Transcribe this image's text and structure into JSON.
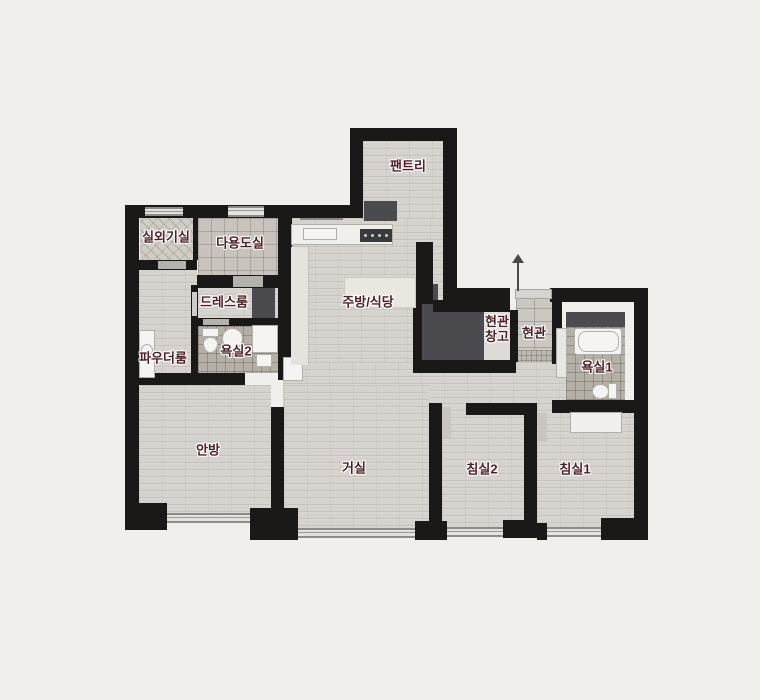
{
  "plan": {
    "type": "apartment-floor-plan",
    "colors": {
      "background": "#f0efeb",
      "wall": "#1b1917",
      "label": "#4d2127",
      "wood_floor": "#d6d3ce",
      "closet_dark": "#4b4a4e",
      "bath_tile": "#b4afa7"
    },
    "icons": {
      "entry_arrow": "arrow-up"
    },
    "rooms": {
      "pantry": {
        "label": "팬트리"
      },
      "outdoor_unit": {
        "label": "실외기실"
      },
      "utility": {
        "label": "다용도실"
      },
      "dress": {
        "label": "드레스룸"
      },
      "kitchen": {
        "label": "주방/식당"
      },
      "powder": {
        "label": "파우더룸"
      },
      "bath2": {
        "label": "욕실2"
      },
      "entry_storage": {
        "label": "현관\n창고"
      },
      "entry": {
        "label": "현관"
      },
      "bath1": {
        "label": "욕실1"
      },
      "master": {
        "label": "안방"
      },
      "living": {
        "label": "거실"
      },
      "bed2": {
        "label": "침실2"
      },
      "bed1": {
        "label": "침실1"
      }
    }
  }
}
